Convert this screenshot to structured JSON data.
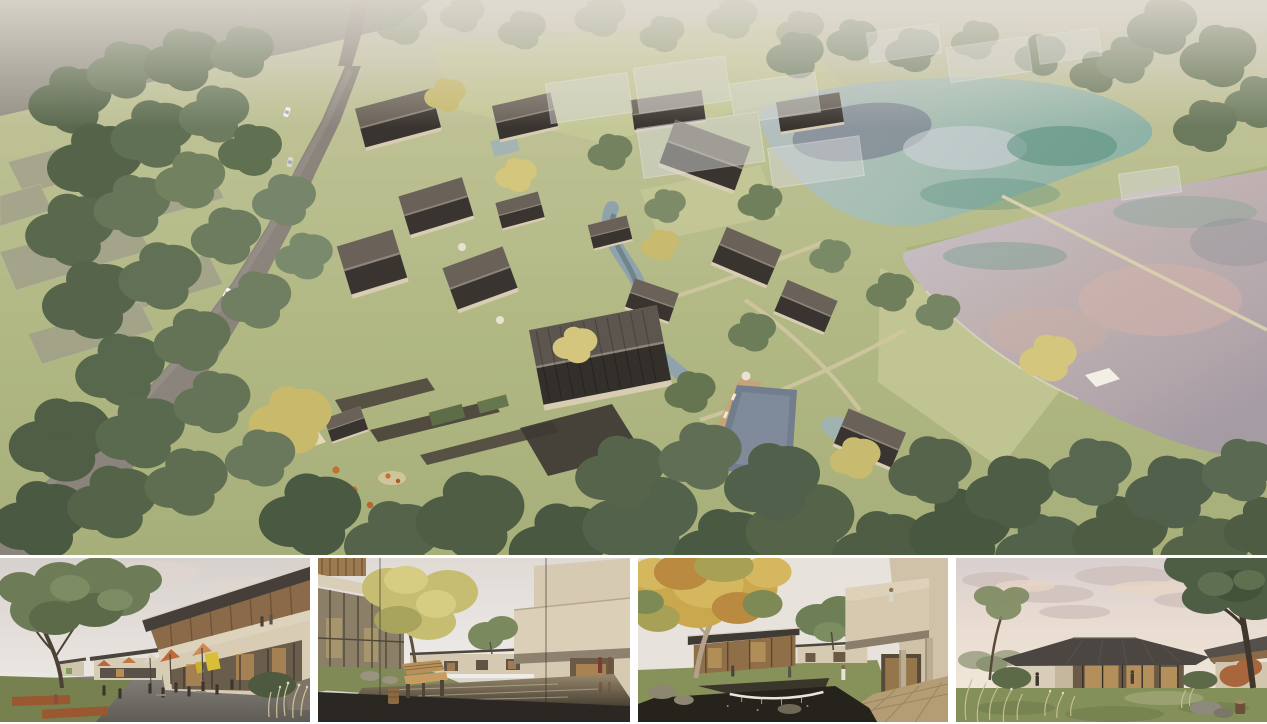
{
  "board": {
    "type": "architecture-rendering-collage",
    "panel_count": 5,
    "gutter_color": "#ffffff",
    "canvas": {
      "width": 1267,
      "height": 724
    }
  },
  "panels": [
    {
      "id": "aerial-masterplan",
      "label": "Aerial masterplan rendering",
      "description": "Bird's-eye view of a village resort: cream houses with dark pitched roofs clustered around a winding stream, stone terraces and a slate-blue pool; a grey road curves through woodland on the left; two lakes with teal and pink reflections lie to the right; ghosted future-phase volumes sit in the hazy distance.",
      "colors": {
        "grass": "#b3ba85",
        "forest": "#55644a",
        "roof": "#3a3631",
        "walls": "#d8ccb3",
        "road": "#8a847c",
        "lake_upper": "#8fb3a6",
        "lake_lower": "#c3bcc6",
        "pool": "#727d8e"
      }
    },
    {
      "id": "street-plaza-view",
      "label": "Street plaza rendering",
      "description": "Eye-level view of a shopping lane: a two-storey building with a timber-lined sloping roof and cafe terrace, orange parasols, visitors at tables on a stone plaza, and a large green tree over the lawn at left.",
      "colors": {
        "sky": "#e6e1dc",
        "umbrella": "#c06a3a",
        "sign": "#d9bf35",
        "plaza": "#7b776f"
      }
    },
    {
      "id": "water-courtyard-view",
      "label": "Water courtyard rendering",
      "description": "A bronze reflecting pond framed by beige courtyard houses, a golden tree on a grassy bank, a slatted wooden bench in the dark foreground and two figures in red coats at right.",
      "colors": {
        "pond": "#6b5d49",
        "bench": "#b89058",
        "walls": "#d8ccb5"
      }
    },
    {
      "id": "garden-pond-view",
      "label": "Garden pond rendering",
      "description": "Courtyard garden with an autumn tree, a dark koi pond spilling over a small waterfall weir, lawn paths, and a cantilevered beige balcony volume with a visitor looking down over columns.",
      "colors": {
        "pond": "#26231d",
        "stone": "#b49c74",
        "autumn": "#c9a84e"
      }
    },
    {
      "id": "dusk-pavilion-view",
      "label": "Lakeside pavilion at dusk",
      "description": "A single-storey pavilion with a wide dark hip roof and a glowing glass wall, set on a lawn with ornamental grasses, rocks and a tree stump, beneath a pink-clouded evening sky with a large tree at right.",
      "colors": {
        "sky": "#e9dcd2",
        "roof": "#4b4641",
        "glow": "#c09a5f",
        "lawn": "#84905a"
      }
    }
  ]
}
